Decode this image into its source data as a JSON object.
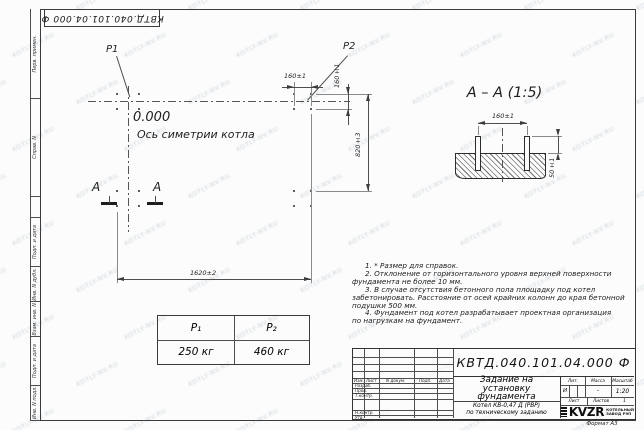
{
  "doc": {
    "number": "КВТД.040.101.04.000 Ф"
  },
  "margin_labels": [
    "Перв. примен.",
    "Справ. N",
    "Подп. и дата",
    "Инв. N дубл.",
    "Взам. инв. N",
    "Подп. и дата",
    "Инв. N подл."
  ],
  "plan": {
    "p1": "P1",
    "p2": "P2",
    "elevation": "0.000",
    "axis_label": "Ось симетрии котла",
    "section_letter_left": "А",
    "section_letter_right": "А",
    "dim_bolt_spacing_top": "160±1",
    "dim_bolt_spacing_side": "160±1",
    "dim_depth": "820±3",
    "dim_width": "1620±2"
  },
  "section": {
    "title": "А – А (1:5)",
    "dim_bolt_spacing": "160±1",
    "dim_protrusion": "50±1"
  },
  "loads_table": {
    "col1_header": "P₁",
    "col2_header": "P₂",
    "col1_value": "250 кг",
    "col2_value": "460 кг"
  },
  "notes": {
    "lines": [
      "1. * Размер для справок.",
      "2. Отклонение от горизонтального уровня верхней поверхности",
      "фундамента не более 10 мм.",
      "3. В случае отсутствия бетонного пола площадку под котел",
      "забетонировать. Расстояние от осей крайних колонн до края бетонной",
      "подушки 500 мм.",
      "4. Фундамент под котел разрабатывает проектная организация",
      "по нагрузкам на фундамент."
    ]
  },
  "title_block": {
    "title_lines": [
      "Задание на",
      "установку",
      "фундамента"
    ],
    "subtitle_lines": [
      "Котел КВ-0,47 Д (РВР)",
      "по техническому заданию"
    ],
    "col_izm": "Изм.",
    "col_list": "Лист",
    "col_ndoc": "N докум.",
    "col_podp": "Подп.",
    "col_data": "Дата",
    "row_razrab": "Разраб.",
    "row_prov": "Пров.",
    "row_tkontr": "Т.контр.",
    "row_nkontr": "Н.контр.",
    "row_utv": "Утв.",
    "lit_label": "Лит.",
    "lit_value": "И",
    "mass_label": "Масса",
    "mass_value": "–",
    "scale_label": "Масштаб",
    "scale_value": "1:20",
    "sheet_label": "Лист",
    "sheets_label": "Листов",
    "sheets_value": "1",
    "logo_text": "KVZR",
    "logo_caption1": "КОТЕЛЬНЫЙ",
    "logo_caption2": "ЗАВОД РЭП",
    "format_label": "Формат А3"
  },
  "watermark": {
    "text": "KOTLY-NV.RU"
  }
}
